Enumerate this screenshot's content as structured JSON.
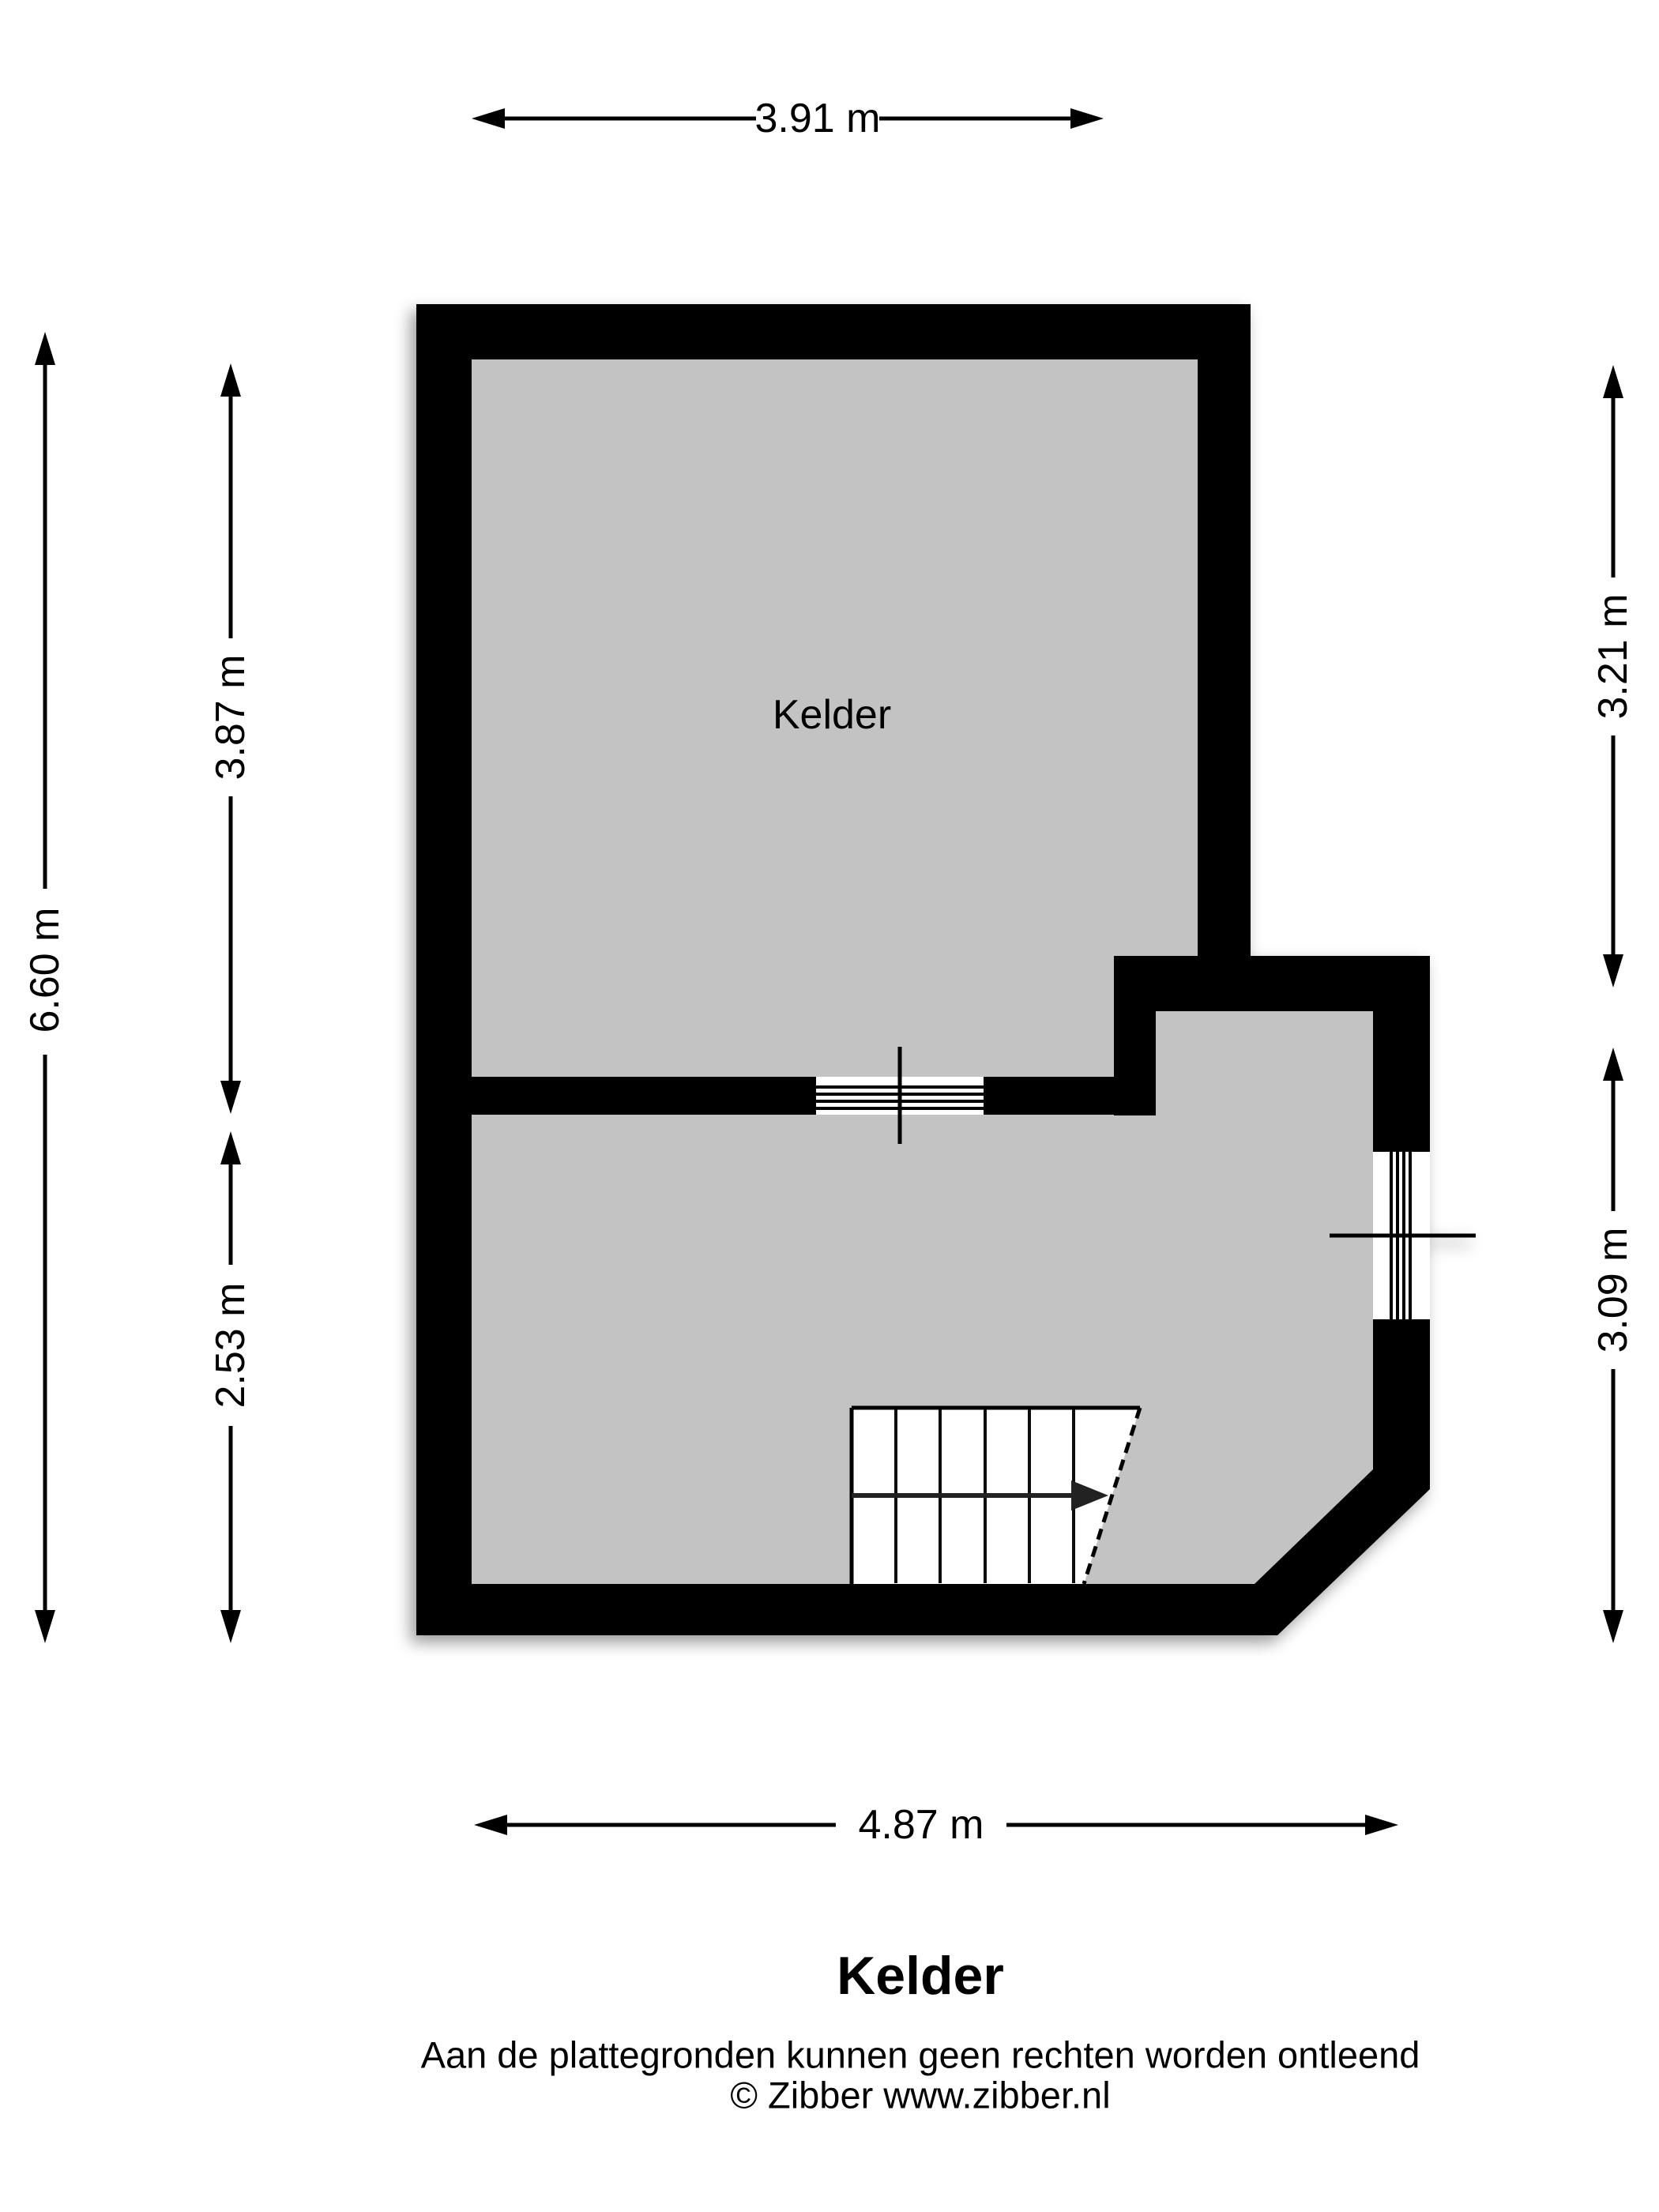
{
  "plan": {
    "room_label": "Kelder",
    "floor_color": "#c3c3c3",
    "wall_color": "#000000"
  },
  "dimensions": {
    "top": "3.91 m",
    "left_total": "6.60 m",
    "left_upper_room": "3.87 m",
    "left_lower_room": "2.53 m",
    "right_upper_room": "3.21 m",
    "right_lower_room": "3.09 m",
    "bottom": "4.87 m"
  },
  "footer": {
    "title": "Kelder",
    "disclaimer": "Aan de plattegronden kunnen geen rechten worden ontleend",
    "copyright": "© Zibber www.zibber.nl"
  }
}
